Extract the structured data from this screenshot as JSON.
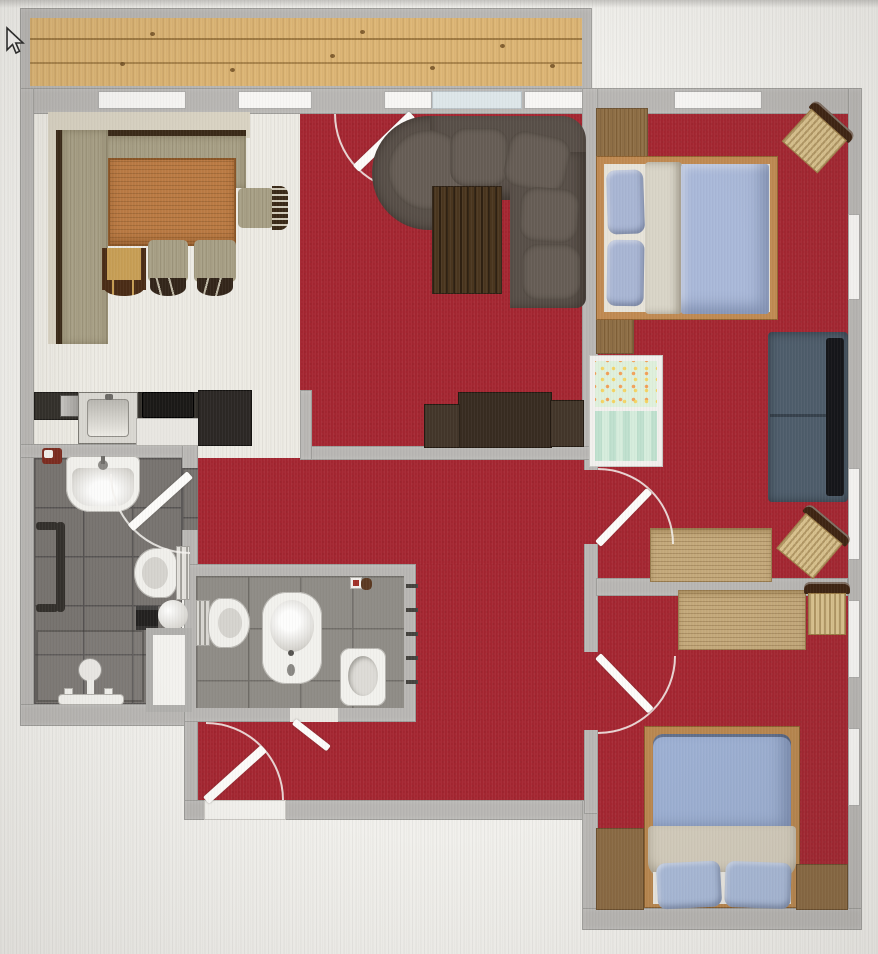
{
  "app": {
    "view": "floor-plan-top-down-render",
    "cursor": "arrow-pointer"
  },
  "colors": {
    "outside": "#f1f0ec",
    "wall_gray": "#b8b6b3",
    "carpet_red": "#a42631",
    "kitchen_floor": "#edebe4",
    "bath_tile": "#75716d",
    "wc_tile": "#8d8a84",
    "wood_deck": "#ddb676",
    "window_white": "#f7f6f4",
    "glass_blue": "#dde6e9",
    "sofa_dark": "#584f48",
    "coffee_table": "#4a361f",
    "sideboard": "#382c21",
    "bench_olive": "#a8a086",
    "table_wood": "#bb7b44",
    "bed_frame": "#c08a52",
    "bed2_frame": "#b9874f",
    "duvet_blue": "#a9b8d8",
    "pillow_blue": "#a8b5d3",
    "blanket_beige": "#d8d4c7",
    "daybed_blue": "#4e5d6b",
    "desk_wood": "#c4a97b",
    "wicker": "#d9c28e",
    "dark_wood": "#3e2412",
    "wardrobe_wood": "#8f6f46",
    "crib_green": "#cfe8d8",
    "cabinet_brown": "#8a6a43"
  },
  "rooms": [
    {
      "name": "balcony",
      "floor": "wood-deck"
    },
    {
      "name": "kitchen-dining",
      "floor": "light-laminate"
    },
    {
      "name": "living-room",
      "floor": "red-carpet"
    },
    {
      "name": "bedroom-top-right",
      "floor": "red-carpet"
    },
    {
      "name": "bedroom-bottom-right",
      "floor": "red-carpet"
    },
    {
      "name": "bathroom",
      "floor": "dark-gray-tile"
    },
    {
      "name": "wc",
      "floor": "gray-tile"
    },
    {
      "name": "hallway",
      "floor": "red-carpet"
    }
  ],
  "furniture": {
    "kitchen_dining": [
      "corner-bench",
      "dining-table",
      "dining-chair",
      "dining-chair",
      "side-chair",
      "wooden-stool",
      "kitchen-counter",
      "sink-unit",
      "cooktop",
      "tall-cabinet",
      "small-appliance"
    ],
    "living_room": [
      "corner-sofa",
      "coffee-table",
      "sideboard",
      "balcony-door"
    ],
    "bedroom_top_right": [
      "double-bed",
      "wardrobe",
      "dresser",
      "wicker-chair",
      "crib",
      "daybed-sofa",
      "desk",
      "wicker-desk-chair"
    ],
    "bedroom_bottom_right": [
      "desk",
      "desk-chair",
      "single-bed",
      "low-cabinet",
      "low-cabinet"
    ],
    "bathroom": [
      "washbasin",
      "towel-radiator",
      "toilet",
      "storage-box",
      "round-stool",
      "shower-cabin",
      "bathtub-fixture"
    ],
    "wc": [
      "toilet",
      "bidet",
      "washbasin",
      "wall-radiator"
    ],
    "hallway": [
      "entrance-door"
    ]
  }
}
